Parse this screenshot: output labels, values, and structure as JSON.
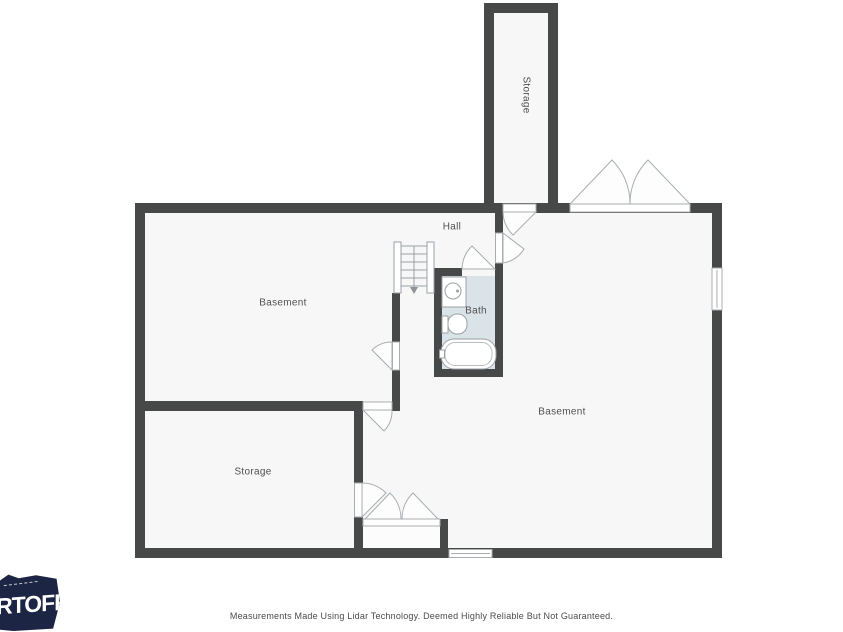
{
  "plan": {
    "labels": {
      "basement_left": "Basement",
      "basement_right": "Basement",
      "storage_top": "Storage",
      "storage_bottom": "Storage",
      "hall": "Hall",
      "bath": "Bath"
    },
    "colors": {
      "wall": "#474848",
      "floor": "#f7f7f8",
      "bath_floor": "#dae3e7",
      "symbol_outline": "#9ba1a5",
      "label_text": "#4f4f4f"
    }
  },
  "branding": {
    "logo_text": "RTOFF",
    "logo_bg": "#1c2544"
  },
  "footer": {
    "disclaimer": "Measurements Made Using Lidar Technology. Deemed Highly Reliable But Not Guaranteed."
  }
}
